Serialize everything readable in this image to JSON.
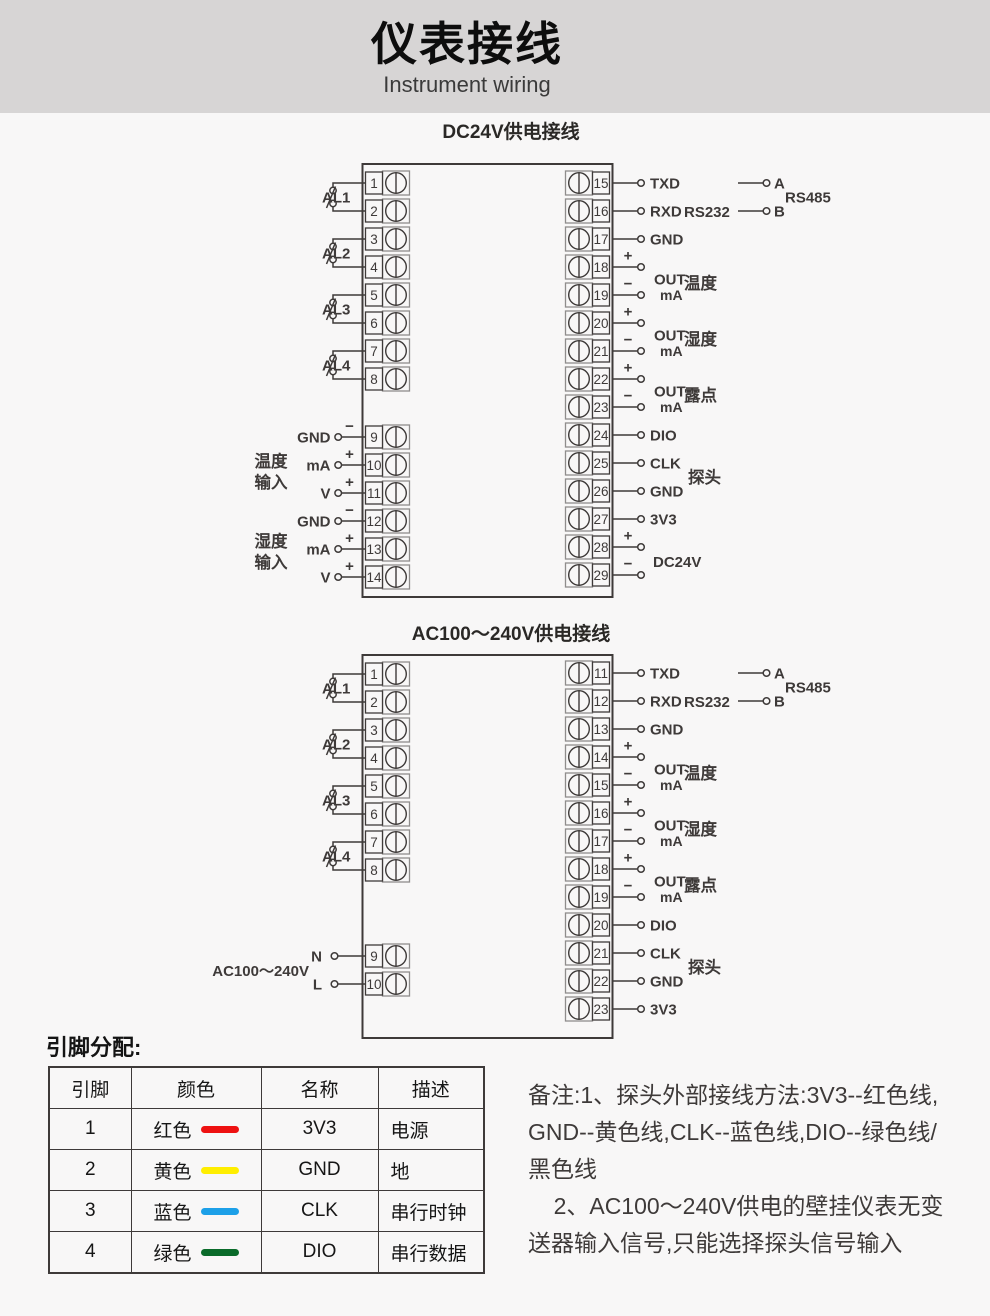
{
  "header": {
    "title": "仪表接线",
    "subtitle": "Instrument wiring"
  },
  "colors": {
    "ink": "#3e3a39",
    "light_stroke": "#8f8d8c",
    "page_bg": "#f8f7f7",
    "header_bg": "#d7d5d5"
  },
  "diagrams": [
    {
      "title": "DC24V供电接线",
      "box": {
        "x": 362.5,
        "y": 164,
        "w": 250,
        "h": 433
      },
      "left_terminals": [
        {
          "n": "1",
          "y": 183
        },
        {
          "n": "2",
          "y": 211
        },
        {
          "n": "3",
          "y": 239
        },
        {
          "n": "4",
          "y": 267
        },
        {
          "n": "5",
          "y": 295
        },
        {
          "n": "6",
          "y": 323
        },
        {
          "n": "7",
          "y": 351
        },
        {
          "n": "8",
          "y": 379
        },
        {
          "n": "9",
          "y": 437
        },
        {
          "n": "10",
          "y": 465
        },
        {
          "n": "11",
          "y": 493
        },
        {
          "n": "12",
          "y": 521
        },
        {
          "n": "13",
          "y": 549
        },
        {
          "n": "14",
          "y": 577
        }
      ],
      "right_terminals": [
        {
          "n": "15",
          "y": 183
        },
        {
          "n": "16",
          "y": 211
        },
        {
          "n": "17",
          "y": 239
        },
        {
          "n": "18",
          "y": 267
        },
        {
          "n": "19",
          "y": 295
        },
        {
          "n": "20",
          "y": 323
        },
        {
          "n": "21",
          "y": 351
        },
        {
          "n": "22",
          "y": 379
        },
        {
          "n": "23",
          "y": 407
        },
        {
          "n": "24",
          "y": 435
        },
        {
          "n": "25",
          "y": 463
        },
        {
          "n": "26",
          "y": 491
        },
        {
          "n": "27",
          "y": 519
        },
        {
          "n": "28",
          "y": 547
        },
        {
          "n": "29",
          "y": 575
        }
      ],
      "relays": [
        {
          "label": "AL1",
          "y1": 183,
          "y2": 211
        },
        {
          "label": "AL2",
          "y1": 239,
          "y2": 267
        },
        {
          "label": "AL3",
          "y1": 295,
          "y2": 323
        },
        {
          "label": "AL4",
          "y1": 351,
          "y2": 379
        }
      ],
      "left_leads": [
        {
          "y": 437,
          "label": "GND",
          "sign": "−"
        },
        {
          "y": 465,
          "label": "mA",
          "sign": "+"
        },
        {
          "y": 493,
          "label": "V",
          "sign": "+"
        },
        {
          "y": 521,
          "label": "GND",
          "sign": "−"
        },
        {
          "y": 549,
          "label": "mA",
          "sign": "+"
        },
        {
          "y": 577,
          "label": "V",
          "sign": "+"
        }
      ],
      "left_groups": [
        {
          "lines": [
            "温度",
            "输入"
          ],
          "cy": 474
        },
        {
          "lines": [
            "湿度",
            "输入"
          ],
          "cy": 554
        }
      ],
      "right_leads": [
        {
          "y": 183,
          "label": "TXD"
        },
        {
          "y": 211,
          "label": "RXD"
        },
        {
          "y": 239,
          "label": "GND"
        },
        {
          "y": 267,
          "sign": "+"
        },
        {
          "y": 295,
          "sign": "−"
        },
        {
          "y": 323,
          "sign": "+"
        },
        {
          "y": 351,
          "sign": "−"
        },
        {
          "y": 379,
          "sign": "+"
        },
        {
          "y": 407,
          "sign": "−"
        },
        {
          "y": 435,
          "label": "DIO"
        },
        {
          "y": 463,
          "label": "CLK"
        },
        {
          "y": 491,
          "label": "GND"
        },
        {
          "y": 519,
          "label": "3V3"
        },
        {
          "y": 547,
          "sign": "+"
        },
        {
          "y": 575,
          "sign": "−"
        }
      ],
      "pairs": [
        {
          "cy": 281,
          "out": "OUT",
          "unit": "mA",
          "cat": "温度"
        },
        {
          "cy": 337,
          "out": "OUT",
          "unit": "mA",
          "cat": "湿度"
        },
        {
          "cy": 393,
          "out": "OUT",
          "unit": "mA",
          "cat": "露点"
        }
      ],
      "texts": [
        {
          "t": "RS232",
          "x": 684,
          "y": 217,
          "bold": true,
          "size": 15
        },
        {
          "t": "探头",
          "x": 688,
          "y": 483,
          "size": 16.5
        },
        {
          "t": "DC24V",
          "x": 653,
          "y": 567,
          "bold": true,
          "size": 15
        }
      ],
      "rs485": {
        "a": "A",
        "b": "B",
        "label": "RS485",
        "yA": 183,
        "yB": 211
      }
    },
    {
      "title": "AC100～240V供电接线",
      "box": {
        "x": 362.5,
        "y": 655,
        "w": 250,
        "h": 383
      },
      "left_terminals": [
        {
          "n": "1",
          "y": 674
        },
        {
          "n": "2",
          "y": 702
        },
        {
          "n": "3",
          "y": 730
        },
        {
          "n": "4",
          "y": 758
        },
        {
          "n": "5",
          "y": 786
        },
        {
          "n": "6",
          "y": 814
        },
        {
          "n": "7",
          "y": 842
        },
        {
          "n": "8",
          "y": 870
        },
        {
          "n": "9",
          "y": 956
        },
        {
          "n": "10",
          "y": 984
        }
      ],
      "right_terminals": [
        {
          "n": "11",
          "y": 673
        },
        {
          "n": "12",
          "y": 701
        },
        {
          "n": "13",
          "y": 729
        },
        {
          "n": "14",
          "y": 757
        },
        {
          "n": "15",
          "y": 785
        },
        {
          "n": "16",
          "y": 813
        },
        {
          "n": "17",
          "y": 841
        },
        {
          "n": "18",
          "y": 869
        },
        {
          "n": "19",
          "y": 897
        },
        {
          "n": "20",
          "y": 925
        },
        {
          "n": "21",
          "y": 953
        },
        {
          "n": "22",
          "y": 981
        },
        {
          "n": "23",
          "y": 1009
        }
      ],
      "relays": [
        {
          "label": "AL1",
          "y1": 674,
          "y2": 702
        },
        {
          "label": "AL2",
          "y1": 730,
          "y2": 758
        },
        {
          "label": "AL3",
          "y1": 786,
          "y2": 814
        },
        {
          "label": "AL4",
          "y1": 842,
          "y2": 870
        }
      ],
      "left_leads": [],
      "left_groups": [],
      "power": {
        "label": "AC100～240V",
        "n": "N",
        "l": "L",
        "yN": 956,
        "yL": 984
      },
      "right_leads": [
        {
          "y": 673,
          "label": "TXD"
        },
        {
          "y": 701,
          "label": "RXD"
        },
        {
          "y": 729,
          "label": "GND"
        },
        {
          "y": 757,
          "sign": "+"
        },
        {
          "y": 785,
          "sign": "−"
        },
        {
          "y": 813,
          "sign": "+"
        },
        {
          "y": 841,
          "sign": "−"
        },
        {
          "y": 869,
          "sign": "+"
        },
        {
          "y": 897,
          "sign": "−"
        },
        {
          "y": 925,
          "label": "DIO"
        },
        {
          "y": 953,
          "label": "CLK"
        },
        {
          "y": 981,
          "label": "GND"
        },
        {
          "y": 1009,
          "label": "3V3"
        }
      ],
      "pairs": [
        {
          "cy": 771,
          "out": "OUT",
          "unit": "mA",
          "cat": "温度"
        },
        {
          "cy": 827,
          "out": "OUT",
          "unit": "mA",
          "cat": "湿度"
        },
        {
          "cy": 883,
          "out": "OUT",
          "unit": "mA",
          "cat": "露点"
        }
      ],
      "texts": [
        {
          "t": "RS232",
          "x": 684,
          "y": 707,
          "bold": true,
          "size": 15
        },
        {
          "t": "探头",
          "x": 688,
          "y": 973,
          "size": 16.5
        }
      ],
      "rs485": {
        "a": "A",
        "b": "B",
        "label": "RS485",
        "yA": 673,
        "yB": 701
      }
    }
  ],
  "pin_table": {
    "heading": "引脚分配:",
    "columns": [
      "引脚",
      "颜色",
      "名称",
      "描述"
    ],
    "col_widths": [
      82,
      130,
      117,
      106
    ],
    "rows": [
      {
        "pin": "1",
        "color_name": "红色",
        "color_hex": "#ee1111",
        "name": "3V3",
        "desc": "电源"
      },
      {
        "pin": "2",
        "color_name": "黄色",
        "color_hex": "#ffee00",
        "name": "GND",
        "desc": "地"
      },
      {
        "pin": "3",
        "color_name": "蓝色",
        "color_hex": "#1da0e8",
        "name": "CLK",
        "desc": "串行时钟"
      },
      {
        "pin": "4",
        "color_name": "绿色",
        "color_hex": "#0a6b2a",
        "name": "DIO",
        "desc": "串行数据"
      }
    ]
  },
  "notes": {
    "lines": [
      "备注:1、探头外部接线方法:3V3--红色线,",
      "GND--黄色线,CLK--蓝色线,DIO--绿色线/",
      "黑色线",
      "    2、AC100～240V供电的壁挂仪表无变",
      "送器输入信号,只能选择探头信号输入"
    ]
  }
}
